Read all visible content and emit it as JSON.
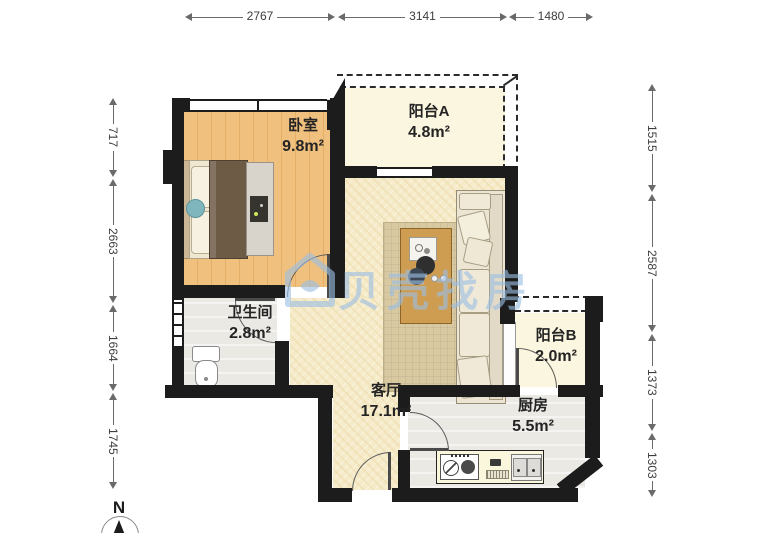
{
  "title": "apartment-floor-plan",
  "watermark": {
    "text": "贝壳找房",
    "logo": "beike-house-logo"
  },
  "compass": {
    "north_label": "N"
  },
  "rooms": [
    {
      "id": "bedroom",
      "name": "卧室",
      "area": "9.8m²"
    },
    {
      "id": "balcony-a",
      "name": "阳台A",
      "area": "4.8m²"
    },
    {
      "id": "living-room",
      "name": "客厅",
      "area": "17.1m²"
    },
    {
      "id": "bathroom",
      "name": "卫生间",
      "area": "2.8m²"
    },
    {
      "id": "balcony-b",
      "name": "阳台B",
      "area": "2.0m²"
    },
    {
      "id": "kitchen",
      "name": "厨房",
      "area": "5.5m²"
    }
  ],
  "dimensions_mm": {
    "top": [
      {
        "value": "2767"
      },
      {
        "value": "3141"
      },
      {
        "value": "1480"
      }
    ],
    "left": [
      {
        "value": "717"
      },
      {
        "value": "2663"
      },
      {
        "value": "1664"
      },
      {
        "value": "1745"
      }
    ],
    "right": [
      {
        "value": "1515"
      },
      {
        "value": "2587"
      },
      {
        "value": "1373"
      },
      {
        "value": "1303"
      }
    ]
  },
  "colors": {
    "wall": "#1c1c1c",
    "bedroom_floor": "#f0c07e",
    "living_floor": "#f6ebc9",
    "balcony_floor": "#fbf6df",
    "wet_room_floor": "#ebe9e4",
    "rug": "#d8c9a1",
    "sofa": "#ece5d4",
    "coffee_table": "#cf9d51",
    "bed_duvet": "#6e5b46",
    "watermark_blue": "#9bbee4",
    "dimension_text": "#3d3d3d"
  }
}
